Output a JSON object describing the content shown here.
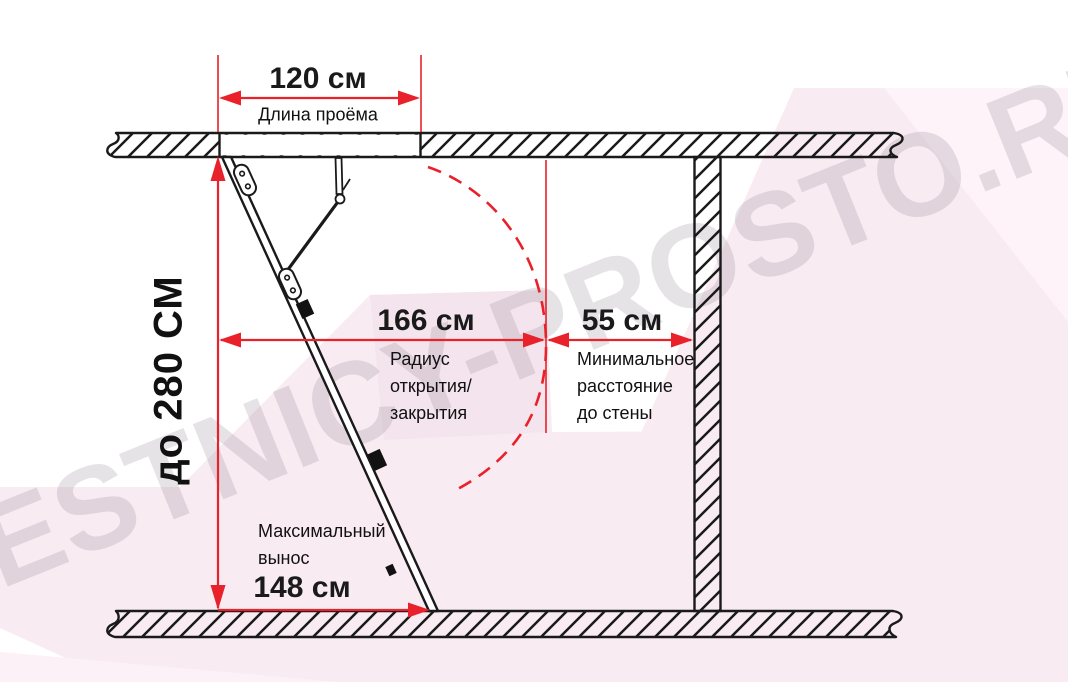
{
  "watermark": {
    "text": "LESTNICY-PROSTO.RU"
  },
  "colors": {
    "dimension_red": "#e8212b",
    "line_black": "#1a1a1a",
    "background_pink": "#f8ebf1",
    "background_pink_light": "#fdf3f8",
    "watermark_gray": "#8f808f"
  },
  "dimensions": {
    "opening": {
      "value": "120 см",
      "label": "Длина проёма"
    },
    "height": {
      "value": "до 280 СМ"
    },
    "radius": {
      "value": "166 см",
      "lines": [
        "Радиус",
        "открытия/",
        "закрытия"
      ]
    },
    "wall": {
      "value": "55 см",
      "lines": [
        "Минимальное",
        "расстояние",
        "до стены"
      ]
    },
    "extension": {
      "value": "148 см",
      "lines": [
        "Максимальный",
        "вынос"
      ]
    }
  }
}
